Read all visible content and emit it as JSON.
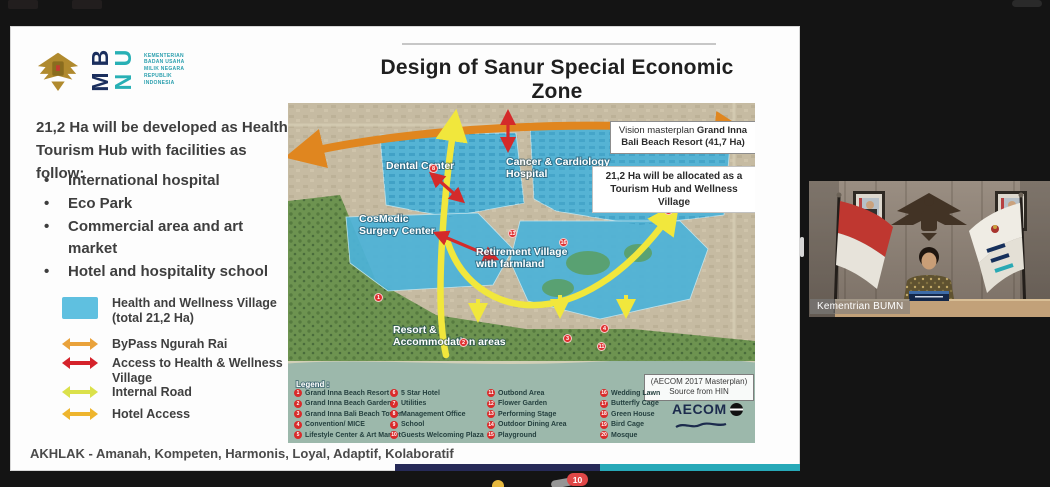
{
  "window": {
    "background": "#141414"
  },
  "slide": {
    "title": "Design of Sanur Special Economic Zone",
    "logo": {
      "bumn_letters": [
        "B",
        "U",
        "M",
        "N"
      ],
      "ministry_lines": [
        "KEMENTERIAN",
        "BADAN USAHA",
        "MILIK NEGARA",
        "REPUBLIK",
        "INDONESIA"
      ]
    },
    "intro": "21,2 Ha will be developed as Health Tourism Hub with facilities as follow:",
    "bullets": [
      "International hospital",
      "Eco Park",
      "Commercial area and art market",
      "Hotel and hospitality school"
    ],
    "legend": {
      "items": [
        {
          "symbol": "swatch",
          "color": "#5fc0e0",
          "label": "Health and Wellness Village (total 21,2 Ha)"
        },
        {
          "symbol": "double-arrow",
          "color": "#e9a23b",
          "label": "ByPass Ngurah Rai"
        },
        {
          "symbol": "double-arrow",
          "color": "#d5232b",
          "label": "Access to Health & Wellness Village"
        },
        {
          "symbol": "double-arrow",
          "color": "#dbe14b",
          "label": "Internal Road"
        },
        {
          "symbol": "double-arrow",
          "color": "#eeb52e",
          "label": "Hotel Access"
        }
      ]
    },
    "footer": "AKHLAK - Amanah, Kompeten, Harmonis, Loyal, Adaptif, Kolaboratif",
    "accent_navy": "#262a58",
    "accent_teal": "#27a9b8"
  },
  "map": {
    "labels": {
      "dental": "Dental Center",
      "cancer_1": "Cancer & Cardiology",
      "cancer_2": "Hospital",
      "cosmedic_1": "CosMedic",
      "cosmedic_2": "Surgery Center",
      "retirement_1": "Retirement Village",
      "retirement_2": "with farmland",
      "resort_1": "Resort &",
      "resort_2": "Accommodation areas"
    },
    "callouts": [
      {
        "prefix": "Vision masterplan ",
        "bold": "Grand Inna Bali Beach Resort (41,7 Ha)"
      },
      {
        "bold": "21,2 Ha will be allocated as a Tourism Hub and Wellness Village"
      }
    ],
    "credit_lines": [
      "(AECOM 2017 Masterplan)",
      "Source from HIN"
    ],
    "aecom_logo": "AECOM",
    "legend_title": "Legend :",
    "legend_items": [
      {
        "n": "1",
        "label": "Grand Inna Beach Resort"
      },
      {
        "n": "2",
        "label": "Grand Inna Beach Garden"
      },
      {
        "n": "3",
        "label": "Grand Inna Bali Beach Tower"
      },
      {
        "n": "4",
        "label": "Convention/ MICE"
      },
      {
        "n": "5",
        "label": "Lifestyle Center & Art Market"
      },
      {
        "n": "6",
        "label": "5 Star Hotel"
      },
      {
        "n": "7",
        "label": "Utilities"
      },
      {
        "n": "8",
        "label": "Management Office"
      },
      {
        "n": "9",
        "label": "School"
      },
      {
        "n": "10",
        "label": "Guests Welcoming Plaza"
      },
      {
        "n": "11",
        "label": "Outbond Area"
      },
      {
        "n": "12",
        "label": "Flower Garden"
      },
      {
        "n": "13",
        "label": "Performing Stage"
      },
      {
        "n": "14",
        "label": "Outdoor Dining Area"
      },
      {
        "n": "15",
        "label": "Playground"
      },
      {
        "n": "16",
        "label": "Wedding Lawn"
      },
      {
        "n": "17",
        "label": "Butterfly Cage"
      },
      {
        "n": "18",
        "label": "Green House"
      },
      {
        "n": "19",
        "label": "Bird Cage"
      },
      {
        "n": "20",
        "label": "Mosque"
      }
    ],
    "markers": [
      {
        "n": "1"
      },
      {
        "n": "2"
      },
      {
        "n": "3"
      },
      {
        "n": "4"
      },
      {
        "n": "8"
      },
      {
        "n": "11"
      },
      {
        "n": "13"
      },
      {
        "n": "16"
      },
      {
        "n": "20"
      }
    ],
    "colors": {
      "zone_blue": "#4db3d8",
      "bypass_arrow": "#e0861f",
      "internal_road": "#f1e73c",
      "access_arrow": "#d42a2a",
      "sea": "#9cb8ab",
      "land": "#c6bba2",
      "vegetation": "#6d9350"
    }
  },
  "video": {
    "label": "Kementrian BUMN"
  },
  "reactions": {
    "badge_count": "10"
  }
}
